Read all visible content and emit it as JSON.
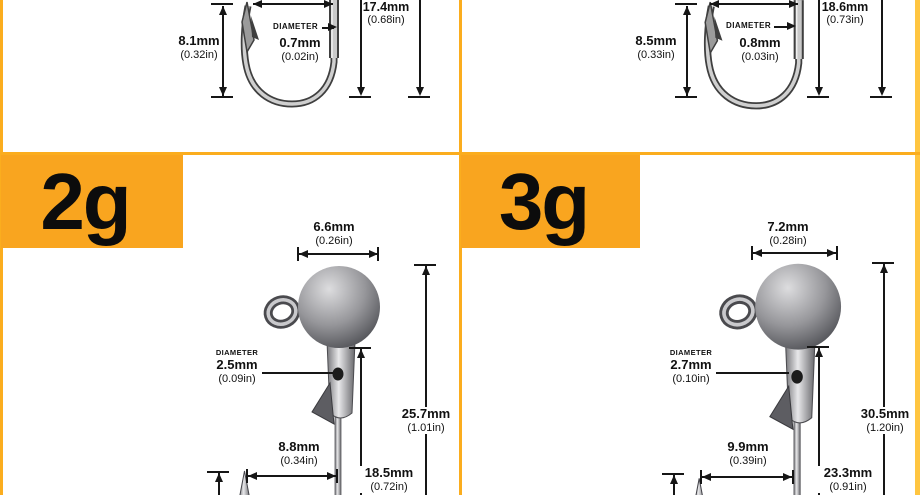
{
  "title": "Jig hook size specification diagram",
  "colors": {
    "accent_orange": "#F9A51F",
    "divider_yellow": "#FBAD1E",
    "border_gold": "#FFC540",
    "text": "#111111"
  },
  "panels": {
    "top_left": {
      "gap_height_mm": "8.1mm",
      "gap_height_in": "(0.32in)",
      "diameter_label": "DIAMETER",
      "diameter_mm": "0.7mm",
      "diameter_in": "(0.02in)",
      "length_mm": "17.4mm",
      "length_in": "(0.68in)"
    },
    "top_right": {
      "gap_height_mm": "8.5mm",
      "gap_height_in": "(0.33in)",
      "diameter_label": "DIAMETER",
      "diameter_mm": "0.8mm",
      "diameter_in": "(0.03in)",
      "length_mm": "18.6mm",
      "length_in": "(0.73in)"
    },
    "bottom_left": {
      "weight": "2g",
      "head_width_mm": "6.6mm",
      "head_width_in": "(0.26in)",
      "diameter_label": "DIAMETER",
      "diameter_mm": "2.5mm",
      "diameter_in": "(0.09in)",
      "total_length_mm": "25.7mm",
      "total_length_in": "(1.01in)",
      "gap_width_mm": "8.8mm",
      "gap_width_in": "(0.34in)",
      "shank_length_mm": "18.5mm",
      "shank_length_in": "(0.72in)"
    },
    "bottom_right": {
      "weight": "3g",
      "head_width_mm": "7.2mm",
      "head_width_in": "(0.28in)",
      "diameter_label": "DIAMETER",
      "diameter_mm": "2.7mm",
      "diameter_in": "(0.10in)",
      "total_length_mm": "30.5mm",
      "total_length_in": "(1.20in)",
      "gap_width_mm": "9.9mm",
      "gap_width_in": "(0.39in)",
      "shank_length_mm": "23.3mm",
      "shank_length_in": "(0.91in)"
    }
  }
}
